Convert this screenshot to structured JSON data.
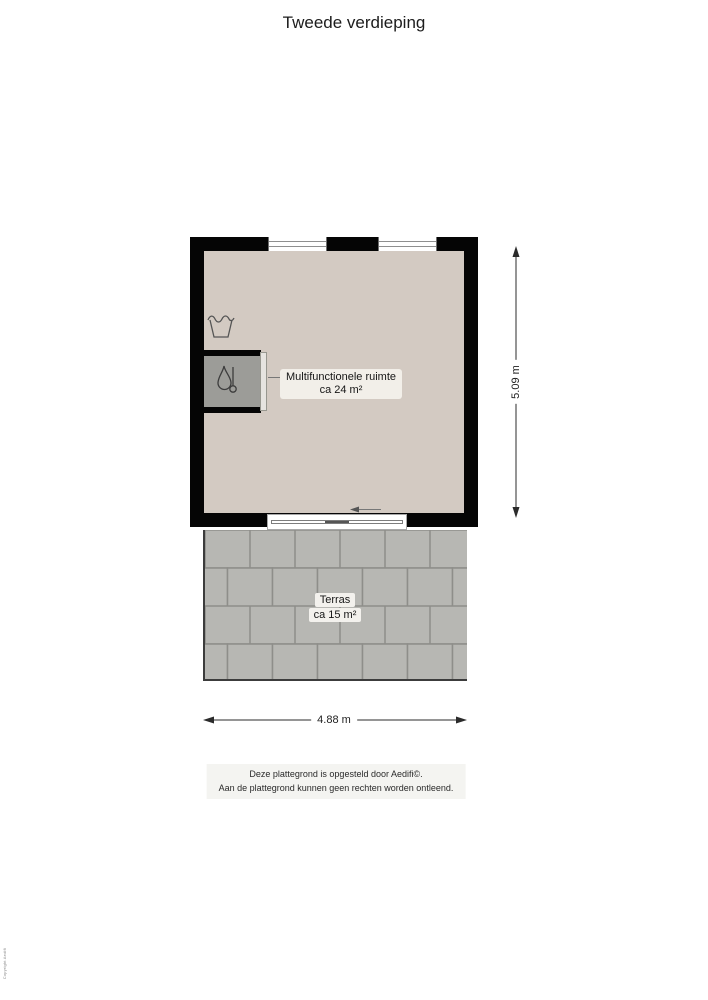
{
  "title": "Tweede verdieping",
  "plan": {
    "room": {
      "name": "Multifunctionele ruimte",
      "area": "ca 24 m²"
    },
    "terrace": {
      "name": "Terras",
      "area": "ca 15 m²"
    },
    "dim_vertical": "5.09 m",
    "dim_horizontal": "4.88 m",
    "icons": {
      "laundry": "laundry-tub-icon",
      "boiler": "boiler-icon",
      "door_arrow": "sliding-door-arrow-icon"
    },
    "colors": {
      "wall": "#050505",
      "floor": "#d3cac2",
      "terrace_tile": "#b7b7b3",
      "terrace_joint": "#8e8e8a",
      "closet": "#9c9c98",
      "label_bg": "#f2efe9"
    }
  },
  "footer": {
    "line1": "Deze plattegrond is opgesteld door Aedifi©.",
    "line2": "Aan de plattegrond kunnen geen rechten worden ontleend."
  },
  "watermark": "Copyright Aedifi"
}
